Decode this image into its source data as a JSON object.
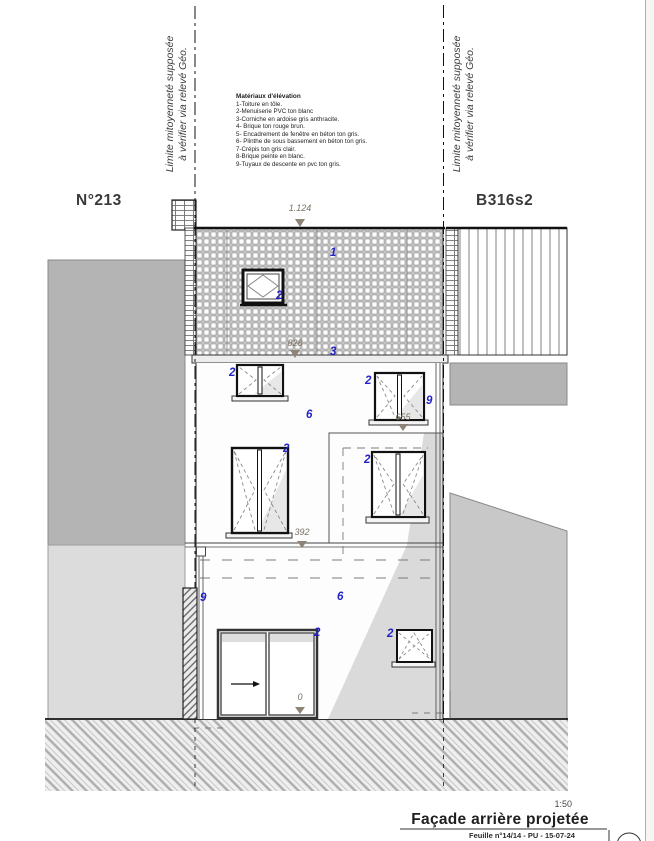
{
  "page": {
    "left_house_number": "N°213",
    "right_parcel_ref": "B316s2",
    "scale": "1:50",
    "drawing_title": "Façade arrière projetée",
    "footer_note": "Feuille n°14/14 - PU - 15-07-24"
  },
  "boundary_notes": {
    "left": {
      "line1": "Limite mitoyenneté supposée",
      "line2": "à vérifier via relevé Géo."
    },
    "right": {
      "line1": "Limite mitoyenneté supposée",
      "line2": "à vérifier via relevé Géo."
    }
  },
  "legend": {
    "title": "Matériaux d'élévation",
    "items": [
      "1-Toiture en tôle.",
      "2-Menuiserie PVC ton blanc",
      "3-Corniche en ardoise gris anthracite.",
      "4- Brique ton rouge brun.",
      "5- Encadrement de fenêtre en béton ton gris.",
      "6- Plinthe de sous bassement en béton ton gris.",
      "7-Crépis ton gris clair.",
      "8-Brique peinte en blanc.",
      "9-Tuyaux de descente en pvc ton gris."
    ]
  },
  "material_labels": [
    "1",
    "2",
    "3",
    "2",
    "2",
    "9",
    "6",
    "2",
    "2",
    "9",
    "6",
    "2",
    "2"
  ],
  "dimensions": [
    "1.124",
    "828",
    "655",
    "392",
    "0"
  ],
  "colors": {
    "label_blue": "#2323c8",
    "dimension_text": "#7a7264",
    "neighbor_dark_gray": "#b4b4b4",
    "neighbor_light_gray": "#dcdcdc",
    "shadow_gray": "#dadada",
    "line_black": "#1a1a1a"
  }
}
